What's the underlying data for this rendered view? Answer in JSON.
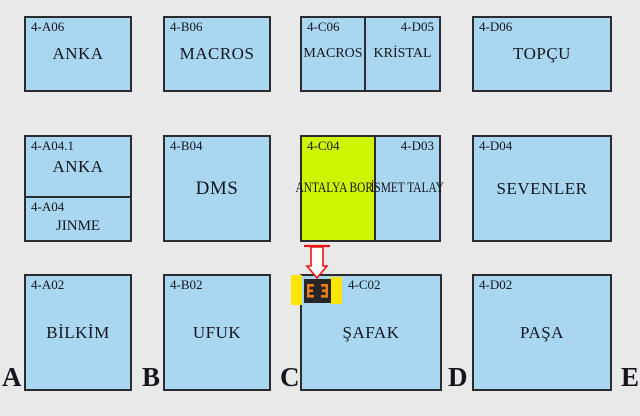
{
  "booths": {
    "a06": {
      "code": "4-A06",
      "name": "ANKA"
    },
    "b06": {
      "code": "4-B06",
      "name": "MACROS"
    },
    "c06": {
      "code": "4-C06",
      "name": "MACROS"
    },
    "d05": {
      "code": "4-D05",
      "name": "KRİSTAL"
    },
    "d06": {
      "code": "4-D06",
      "name": "TOPÇU"
    },
    "a04_1": {
      "code": "4-A04.1",
      "name": "ANKA"
    },
    "a04": {
      "code": "4-A04",
      "name": "JINME"
    },
    "b04": {
      "code": "4-B04",
      "name": "DMS"
    },
    "c04": {
      "code": "4-C04",
      "name": "ANTALYA BORA",
      "highlight": true
    },
    "d03": {
      "code": "4-D03",
      "name": "İSMET TALAY"
    },
    "d04": {
      "code": "4-D04",
      "name": "SEVENLER"
    },
    "a02": {
      "code": "4-A02",
      "name": "BİLKİM"
    },
    "b02": {
      "code": "4-B02",
      "name": "UFUK"
    },
    "c02": {
      "code": "4-C02",
      "name": "ŞAFAK"
    },
    "d02": {
      "code": "4-D02",
      "name": "PAŞA"
    }
  },
  "aisles": [
    "A",
    "B",
    "C",
    "D",
    "E"
  ],
  "icons": {
    "arrow": "down-arrow-pointer",
    "stand": "stand-location-marker"
  },
  "colors": {
    "background": "#e9e9e9",
    "booth_fill": "#a9d6f0",
    "highlight_fill": "#cdf400",
    "border": "#2b2b30",
    "text": "#15151d",
    "marker_yellow": "#ffe500",
    "marker_black": "#262626",
    "marker_orange": "#ee7d1e",
    "arrow_red": "#e81515"
  }
}
